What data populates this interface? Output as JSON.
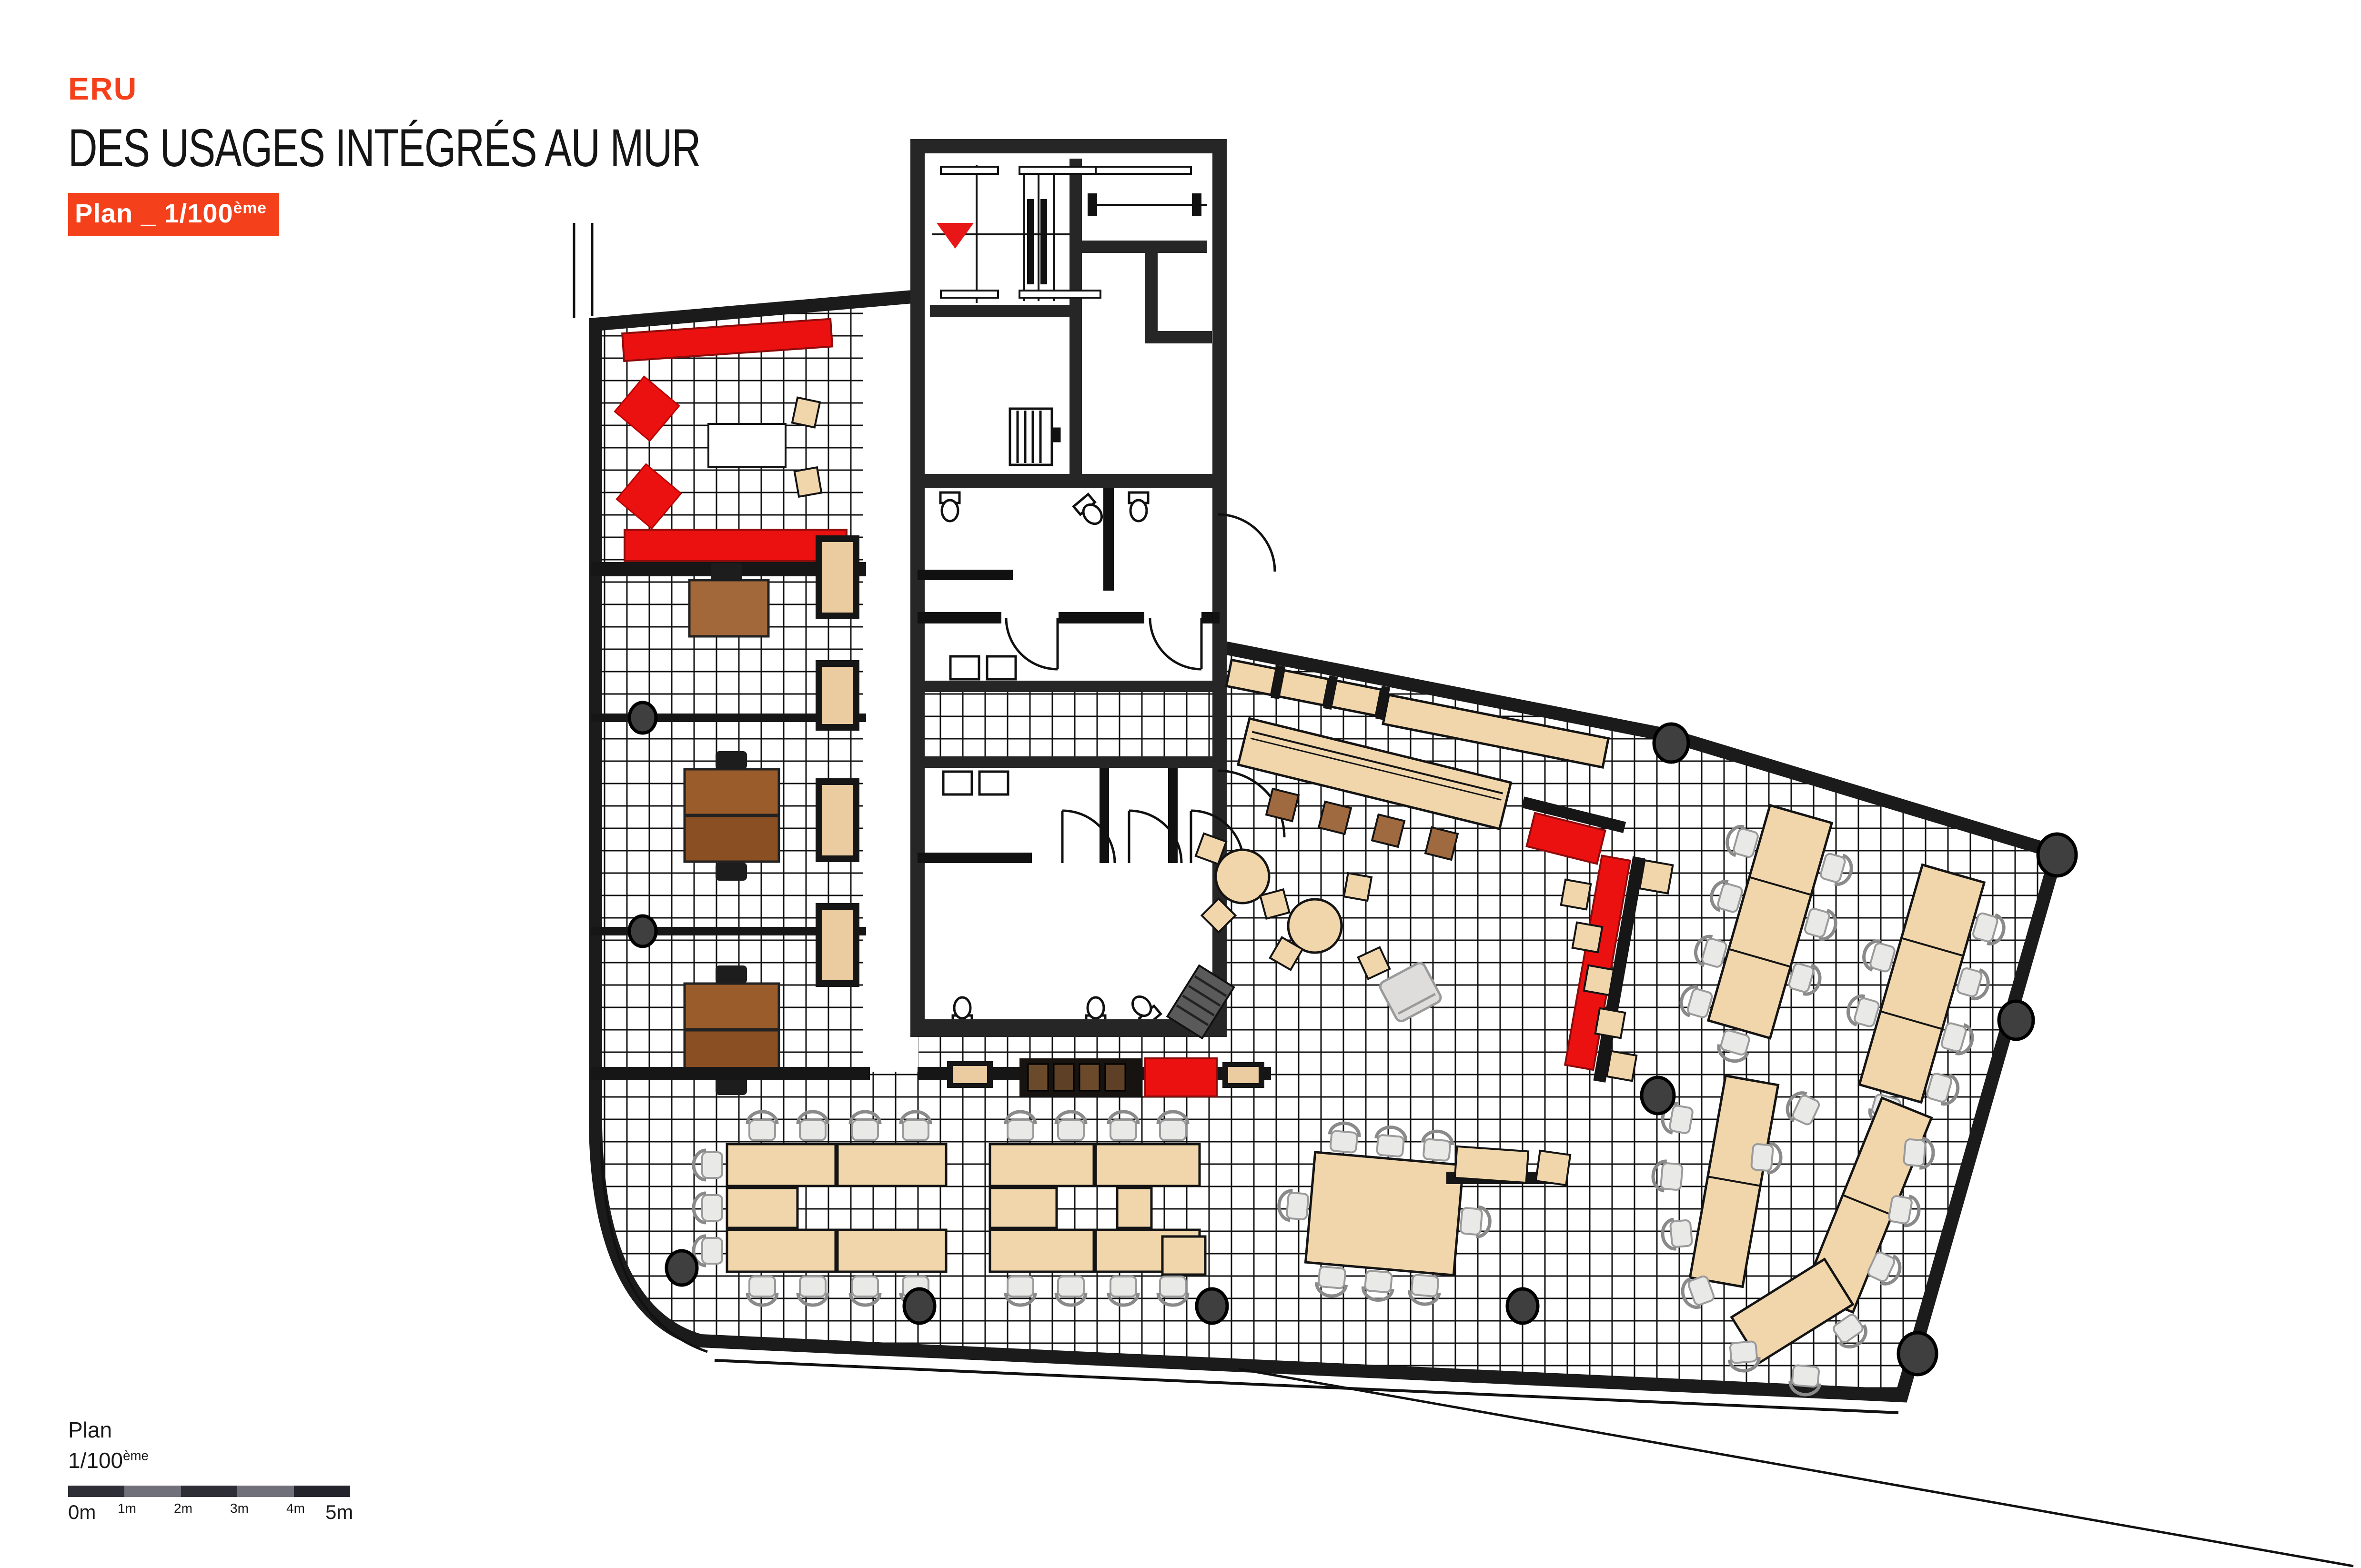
{
  "header": {
    "logo": "ERU",
    "title": "DES USAGES INTÉGRÉS AU MUR",
    "badge_prefix": "Plan _ ",
    "badge_scale": "1/100",
    "badge_sup": "ème"
  },
  "legend": {
    "title": "Plan",
    "scale_base": "1/100",
    "scale_sup": "ème",
    "ticks": [
      "0m",
      "1m",
      "2m",
      "3m",
      "4m",
      "5m"
    ]
  },
  "plan": {
    "markers": {
      "stair_direction_icon": "red-triangle-icon",
      "columns_icon": "round-column-icon",
      "toilets_icon": "toilet-icon",
      "doors_icon": "door-swing-icon"
    },
    "colors": {
      "accent_orange": "#F4411C",
      "plan_red": "#EC1111",
      "wood_beige": "#F1D6AB",
      "stool_brown": "#A06A40",
      "desk_brown": "#9A5C2A",
      "wall_dark": "#1E1E1E",
      "column_gray": "#3F3F3F",
      "chair_gray": "#E9E9E7",
      "scale_dark": "#2E2E36",
      "scale_gray": "#70707A"
    }
  }
}
